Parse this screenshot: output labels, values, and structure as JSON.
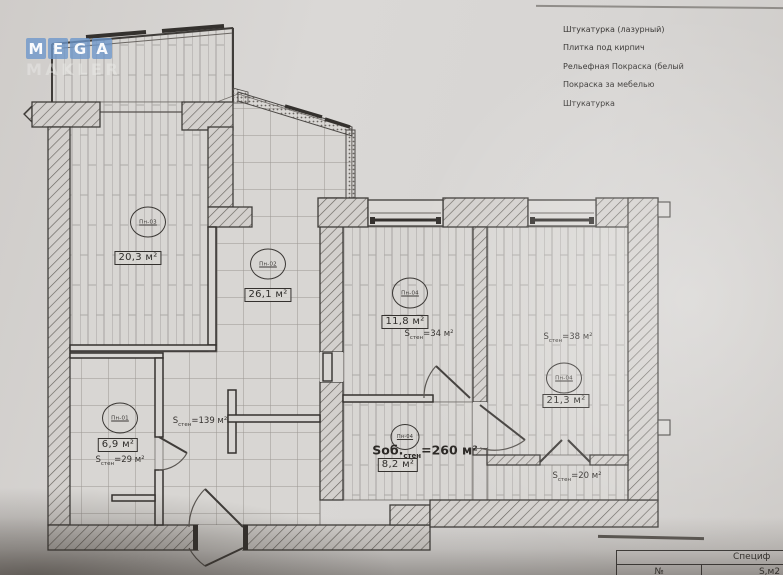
{
  "watermark": {
    "letters": [
      "M",
      "E",
      "G",
      "A"
    ],
    "bottom": "MAKLER"
  },
  "legend": [
    "Штукатурка (лазурный)",
    "Плитка под кирпич",
    "Рельефная Покраска (белый",
    "Покраска за мебелью",
    "Штукатурка"
  ],
  "rooms": [
    {
      "tag": "Пн-03",
      "area": "20,3 м²"
    },
    {
      "tag": "Пн-02",
      "area": "26,1 м²"
    },
    {
      "tag": "Пн-04",
      "area": "11,8 м²",
      "s_prefix": "S",
      "s_sub": "стен",
      "s_value": "=34 м²"
    },
    {
      "tag": "Пн-04",
      "area": "21,3 м²",
      "s_prefix": "S",
      "s_sub": "стен",
      "s_value": "=38 м²"
    },
    {
      "tag": "Пн-01",
      "area": "6,9 м²",
      "s_prefix": "S",
      "s_sub": "стен",
      "s_value": "=29 м²"
    },
    {
      "tag": "Пн-04",
      "area": "8,2 м²",
      "s_prefix": "Sоб.",
      "s_sub": "стен",
      "s_value": "=260 м²"
    }
  ],
  "notes": {
    "hall": {
      "s_prefix": "S",
      "s_sub": "стен",
      "s_value": "=139 м²"
    },
    "bottom_right": {
      "s_prefix": "S",
      "s_sub": "стен",
      "s_value": "=20 м²"
    }
  },
  "spec_table": {
    "title": "Специф",
    "col_no": "№",
    "col_area": "S,м2"
  }
}
